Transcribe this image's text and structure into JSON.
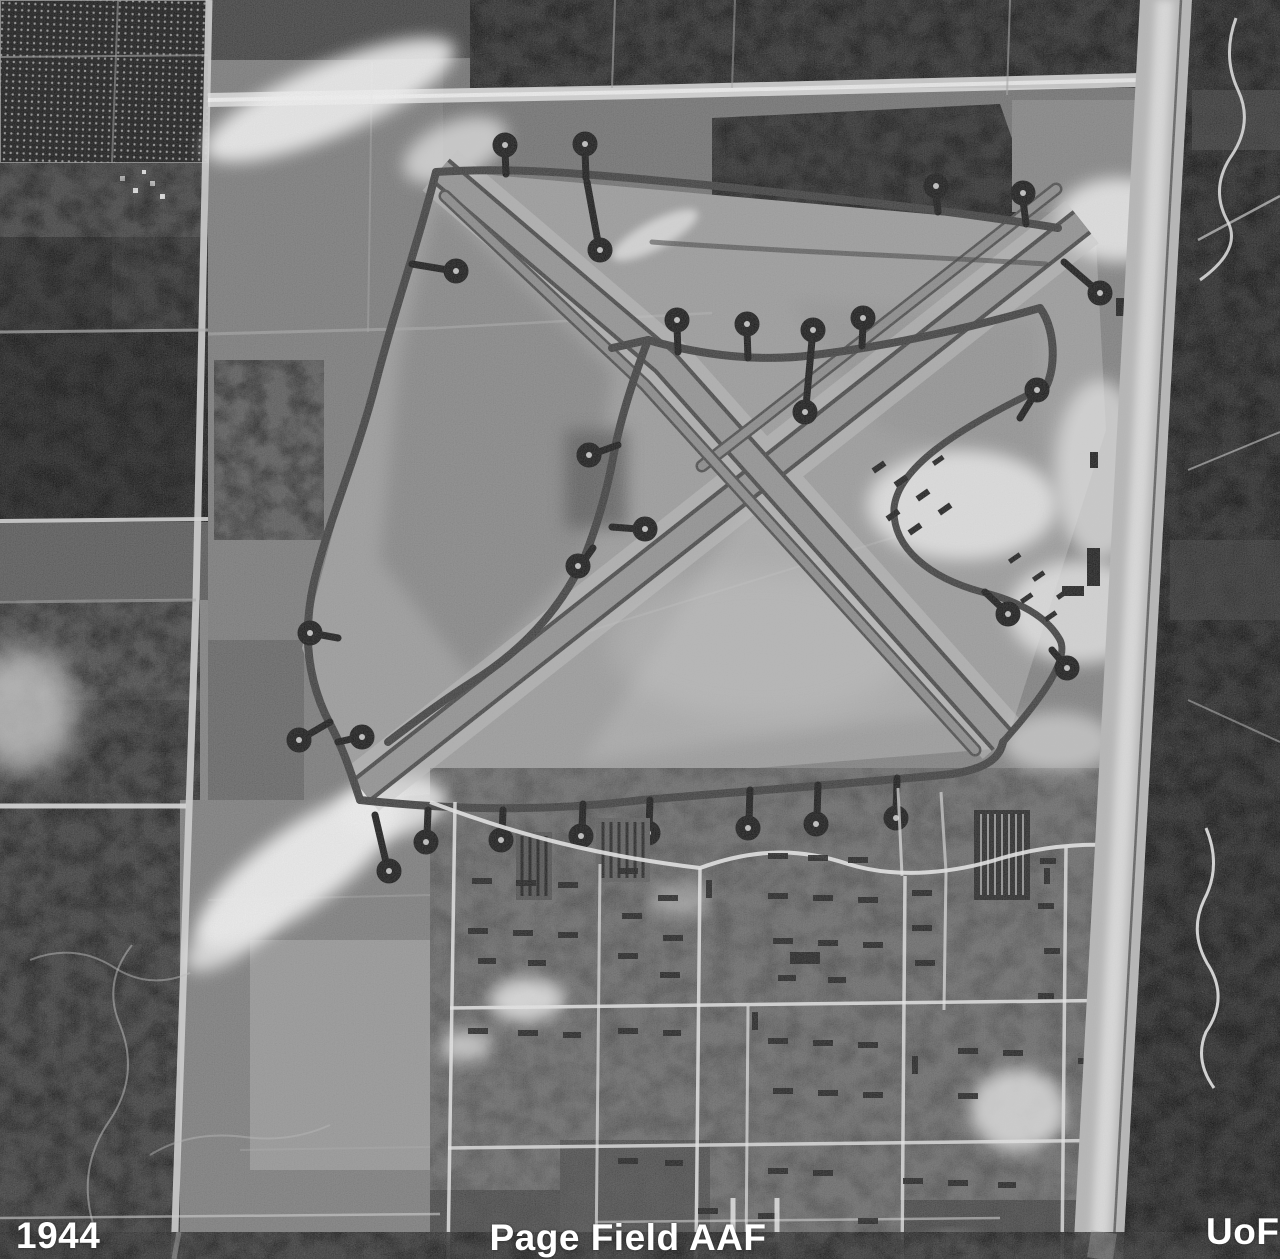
{
  "labels": {
    "year": "1944",
    "site": "Page Field AAF",
    "credit": "UoFl"
  },
  "palette": {
    "ground": "#8a8a8a",
    "airfield_grass": "#999999",
    "forest_dark": "#242424",
    "scrub": "#3a3a3a",
    "pavement": "#8f8f8f",
    "pavement_edge": "#454545",
    "taxiway_dark": "#3c3c3c",
    "dispersal_pad": "#161616",
    "sand_white": "#f2f2f2",
    "road_light": "#d9d9d9",
    "label_text": "#ffffff"
  }
}
